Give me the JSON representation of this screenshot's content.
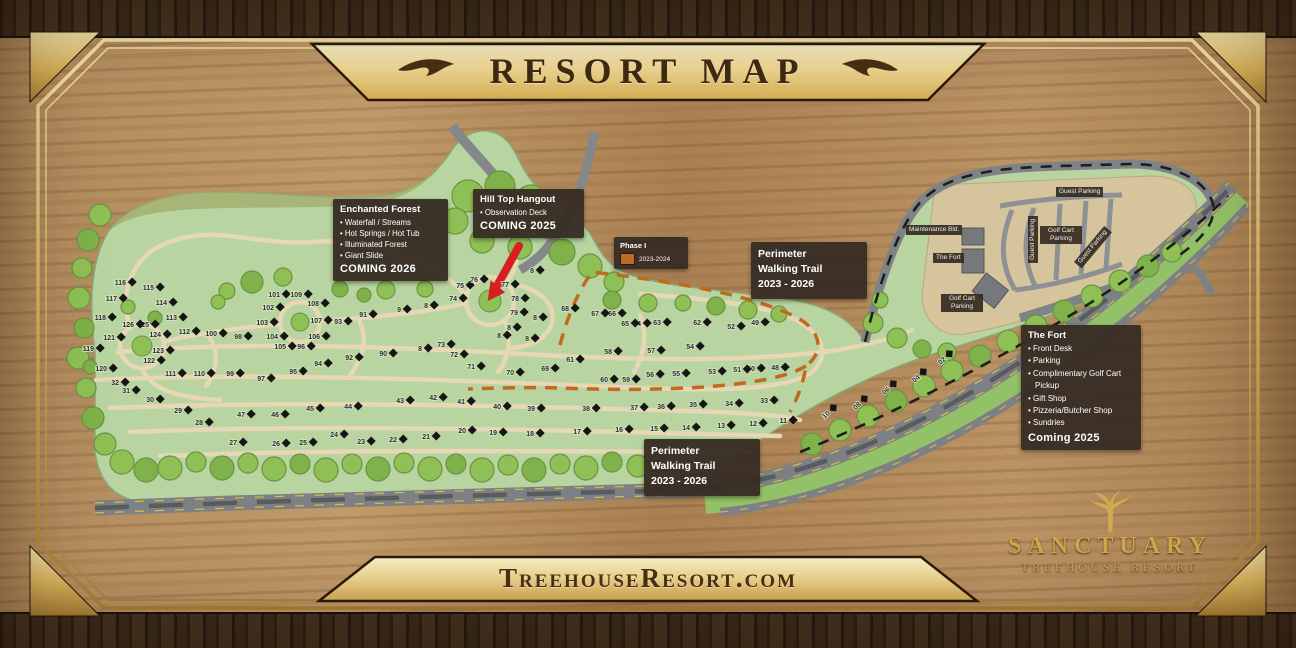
{
  "header": {
    "title": "RESORT MAP"
  },
  "footer": {
    "url": "TreehouseResort.com"
  },
  "logo": {
    "name": "SANCTUARY",
    "tagline": "TREEHOUSE RESORT"
  },
  "legend": {
    "phase": {
      "title": "Phase I",
      "range": "2023-2024",
      "swatch_color": "#bf6b28"
    }
  },
  "callouts": {
    "enchanted_forest": {
      "title": "Enchanted Forest",
      "items": [
        "Waterfall / Streams",
        "Hot Springs / Hot Tub",
        "Illuminated Forest",
        "Giant Slide"
      ],
      "footer": "COMING 2026"
    },
    "hill_top": {
      "title": "Hill Top Hangout",
      "items": [
        "Observation Deck"
      ],
      "footer": "COMING 2025"
    },
    "perimeter_top": {
      "line1": "Perimeter",
      "line2": "Walking Trail",
      "line3": "2023 - 2026"
    },
    "perimeter_bottom": {
      "line1": "Perimeter",
      "line2": "Walking Trail",
      "line3": "2023 - 2026"
    },
    "the_fort": {
      "title": "The Fort",
      "items": [
        "Front Desk",
        "Parking",
        "Complimentary Golf Cart Pickup",
        "Gift Shop",
        "Pizzeria/Butcher Shop",
        "Sundries"
      ],
      "footer": "Coming 2025"
    }
  },
  "map_labels": {
    "guest_parking_top": "Guest Parking",
    "maintenance": "Maintenance Bld.",
    "the_fort": "The Fort",
    "guest_parking_vertical": "Guest Parking",
    "golf_cart_parking_mid": "Golf Cart Parking",
    "guest_parking_diagonal": "Guest Parking",
    "golf_cart_parking_low": "Golf Cart Parking"
  },
  "colors": {
    "frame_gold": "#d9b45e",
    "callout_bg": "#382d24",
    "land_green": "#b7d4a1",
    "tree_green": "#8fc055",
    "trail_tan": "#e7d7b5",
    "road_gray": "#85888b",
    "walking_trail_orange": "#c2691e",
    "arrow_red": "#d81f1f"
  },
  "map": {
    "sites": [
      {
        "n": "02",
        "x": 943,
        "y": 359,
        "r": -40
      },
      {
        "n": "04",
        "x": 917,
        "y": 377,
        "r": -40
      },
      {
        "n": "06",
        "x": 887,
        "y": 389,
        "r": -40
      },
      {
        "n": "08",
        "x": 858,
        "y": 404,
        "r": -40
      },
      {
        "n": "10",
        "x": 827,
        "y": 413,
        "r": -40
      },
      {
        "n": "11",
        "x": 785,
        "y": 420
      },
      {
        "n": "12",
        "x": 755,
        "y": 423
      },
      {
        "n": "13",
        "x": 723,
        "y": 425
      },
      {
        "n": "14",
        "x": 688,
        "y": 427
      },
      {
        "n": "15",
        "x": 656,
        "y": 428
      },
      {
        "n": "16",
        "x": 621,
        "y": 429
      },
      {
        "n": "17",
        "x": 579,
        "y": 431
      },
      {
        "n": "18",
        "x": 532,
        "y": 433
      },
      {
        "n": "19",
        "x": 495,
        "y": 432
      },
      {
        "n": "20",
        "x": 464,
        "y": 430
      },
      {
        "n": "21",
        "x": 428,
        "y": 436
      },
      {
        "n": "22",
        "x": 395,
        "y": 439
      },
      {
        "n": "23",
        "x": 363,
        "y": 441
      },
      {
        "n": "24",
        "x": 336,
        "y": 434
      },
      {
        "n": "25",
        "x": 305,
        "y": 442
      },
      {
        "n": "26",
        "x": 278,
        "y": 443
      },
      {
        "n": "27",
        "x": 235,
        "y": 442
      },
      {
        "n": "28",
        "x": 201,
        "y": 422
      },
      {
        "n": "29",
        "x": 180,
        "y": 410
      },
      {
        "n": "30",
        "x": 152,
        "y": 399
      },
      {
        "n": "31",
        "x": 128,
        "y": 390
      },
      {
        "n": "32",
        "x": 117,
        "y": 382
      },
      {
        "n": "33",
        "x": 766,
        "y": 400
      },
      {
        "n": "34",
        "x": 731,
        "y": 403
      },
      {
        "n": "35",
        "x": 695,
        "y": 404
      },
      {
        "n": "36",
        "x": 663,
        "y": 406
      },
      {
        "n": "37",
        "x": 636,
        "y": 407
      },
      {
        "n": "38",
        "x": 588,
        "y": 408
      },
      {
        "n": "39",
        "x": 533,
        "y": 408
      },
      {
        "n": "40",
        "x": 499,
        "y": 406
      },
      {
        "n": "41",
        "x": 463,
        "y": 401
      },
      {
        "n": "42",
        "x": 435,
        "y": 397
      },
      {
        "n": "43",
        "x": 402,
        "y": 400
      },
      {
        "n": "44",
        "x": 350,
        "y": 406
      },
      {
        "n": "45",
        "x": 312,
        "y": 408
      },
      {
        "n": "46",
        "x": 277,
        "y": 414
      },
      {
        "n": "47",
        "x": 243,
        "y": 414
      },
      {
        "n": "48",
        "x": 777,
        "y": 367
      },
      {
        "n": "49",
        "x": 757,
        "y": 322
      },
      {
        "n": "50",
        "x": 753,
        "y": 368
      },
      {
        "n": "51",
        "x": 739,
        "y": 369
      },
      {
        "n": "52",
        "x": 733,
        "y": 326
      },
      {
        "n": "53",
        "x": 714,
        "y": 371
      },
      {
        "n": "54",
        "x": 692,
        "y": 346
      },
      {
        "n": "55",
        "x": 678,
        "y": 373
      },
      {
        "n": "56",
        "x": 652,
        "y": 374
      },
      {
        "n": "57",
        "x": 653,
        "y": 350
      },
      {
        "n": "58",
        "x": 610,
        "y": 351
      },
      {
        "n": "59",
        "x": 628,
        "y": 379
      },
      {
        "n": "60",
        "x": 606,
        "y": 379
      },
      {
        "n": "61",
        "x": 572,
        "y": 359
      },
      {
        "n": "62",
        "x": 699,
        "y": 322
      },
      {
        "n": "63",
        "x": 659,
        "y": 322
      },
      {
        "n": "64",
        "x": 639,
        "y": 323
      },
      {
        "n": "65",
        "x": 627,
        "y": 323
      },
      {
        "n": "66",
        "x": 614,
        "y": 313
      },
      {
        "n": "67",
        "x": 597,
        "y": 313
      },
      {
        "n": "68",
        "x": 567,
        "y": 308
      },
      {
        "n": "69",
        "x": 547,
        "y": 368
      },
      {
        "n": "70",
        "x": 512,
        "y": 372
      },
      {
        "n": "71",
        "x": 473,
        "y": 366
      },
      {
        "n": "72",
        "x": 456,
        "y": 354
      },
      {
        "n": "73",
        "x": 443,
        "y": 344
      },
      {
        "n": "74",
        "x": 455,
        "y": 298
      },
      {
        "n": "75",
        "x": 462,
        "y": 285
      },
      {
        "n": "76",
        "x": 476,
        "y": 279
      },
      {
        "n": "77",
        "x": 507,
        "y": 284
      },
      {
        "n": "78",
        "x": 517,
        "y": 298
      },
      {
        "n": "79",
        "x": 516,
        "y": 312
      },
      {
        "n": "8",
        "x": 532,
        "y": 270
      },
      {
        "n": "8",
        "x": 535,
        "y": 317
      },
      {
        "n": "8",
        "x": 509,
        "y": 327
      },
      {
        "n": "8",
        "x": 499,
        "y": 335
      },
      {
        "n": "8",
        "x": 426,
        "y": 305
      },
      {
        "n": "8",
        "x": 420,
        "y": 348
      },
      {
        "n": "8",
        "x": 527,
        "y": 338
      },
      {
        "n": "9",
        "x": 399,
        "y": 309
      },
      {
        "n": "90",
        "x": 385,
        "y": 353
      },
      {
        "n": "91",
        "x": 365,
        "y": 314
      },
      {
        "n": "92",
        "x": 351,
        "y": 357
      },
      {
        "n": "93",
        "x": 340,
        "y": 321
      },
      {
        "n": "94",
        "x": 320,
        "y": 363
      },
      {
        "n": "95",
        "x": 295,
        "y": 371
      },
      {
        "n": "96",
        "x": 303,
        "y": 346
      },
      {
        "n": "97",
        "x": 263,
        "y": 378
      },
      {
        "n": "98",
        "x": 240,
        "y": 336
      },
      {
        "n": "99",
        "x": 232,
        "y": 373
      },
      {
        "n": "100",
        "x": 215,
        "y": 333
      },
      {
        "n": "101",
        "x": 278,
        "y": 294
      },
      {
        "n": "102",
        "x": 272,
        "y": 307
      },
      {
        "n": "103",
        "x": 266,
        "y": 322
      },
      {
        "n": "104",
        "x": 276,
        "y": 336
      },
      {
        "n": "105",
        "x": 284,
        "y": 346
      },
      {
        "n": "106",
        "x": 318,
        "y": 336
      },
      {
        "n": "107",
        "x": 320,
        "y": 320
      },
      {
        "n": "108",
        "x": 317,
        "y": 303
      },
      {
        "n": "109",
        "x": 300,
        "y": 294
      },
      {
        "n": "110",
        "x": 203,
        "y": 373
      },
      {
        "n": "111",
        "x": 174,
        "y": 373
      },
      {
        "n": "112",
        "x": 188,
        "y": 331
      },
      {
        "n": "113",
        "x": 175,
        "y": 317
      },
      {
        "n": "114",
        "x": 165,
        "y": 302
      },
      {
        "n": "115",
        "x": 152,
        "y": 287
      },
      {
        "n": "116",
        "x": 124,
        "y": 282
      },
      {
        "n": "117",
        "x": 115,
        "y": 298
      },
      {
        "n": "118",
        "x": 104,
        "y": 317
      },
      {
        "n": "119",
        "x": 92,
        "y": 348
      },
      {
        "n": "120",
        "x": 105,
        "y": 368
      },
      {
        "n": "121",
        "x": 113,
        "y": 337
      },
      {
        "n": "122",
        "x": 153,
        "y": 360
      },
      {
        "n": "123",
        "x": 162,
        "y": 350
      },
      {
        "n": "124",
        "x": 159,
        "y": 334
      },
      {
        "n": "125",
        "x": 147,
        "y": 324
      },
      {
        "n": "126",
        "x": 132,
        "y": 324
      }
    ]
  }
}
